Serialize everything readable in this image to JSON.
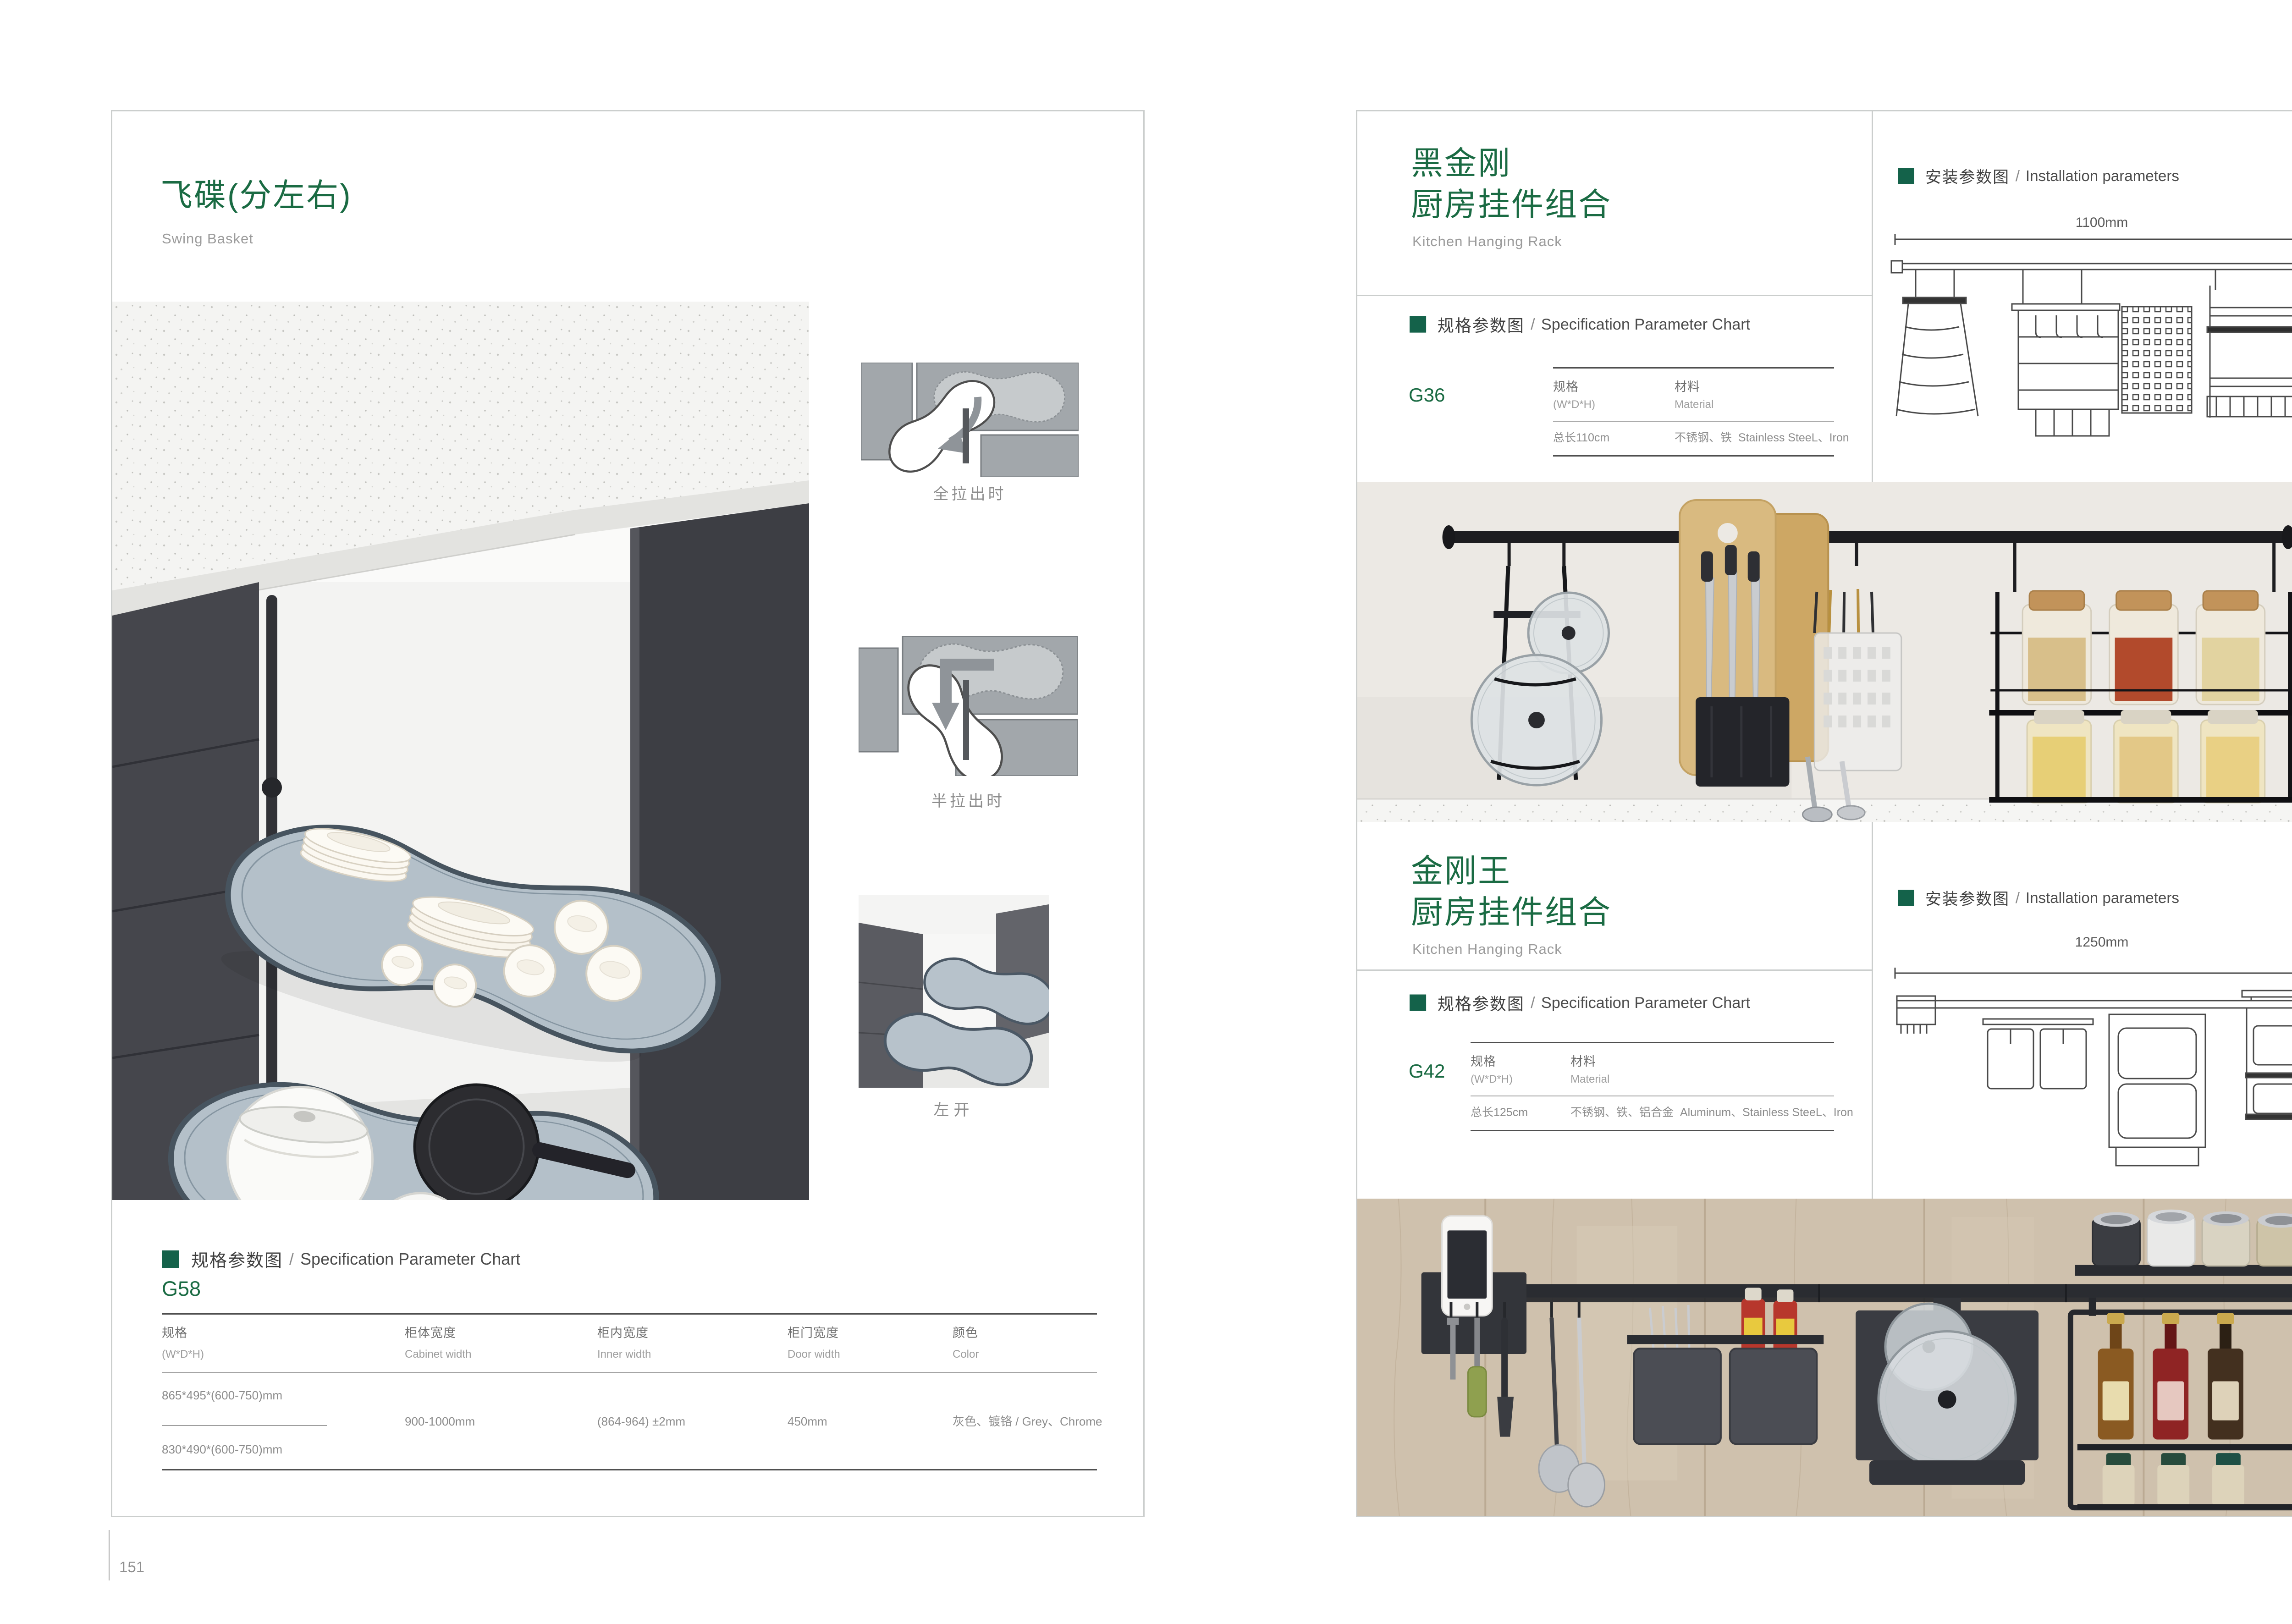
{
  "common": {
    "sep": "/"
  },
  "colors": {
    "accent_green": "#1a6b43",
    "marker_green": "#14624a",
    "border_gray": "#cbcecd"
  },
  "left": {
    "title": "飞碟(分左右)",
    "subtitle": "Swing Basket",
    "captions": {
      "full": "全拉出时",
      "half": "半拉出时",
      "open": "左开"
    },
    "section": {
      "cn": "规格参数图",
      "en": "Specification Parameter Chart"
    },
    "model": "G58",
    "table": {
      "h_spec_cn": "规格",
      "h_spec_en": "(W*D*H)",
      "h_cab_cn": "柜体宽度",
      "h_cab_en": "Cabinet width",
      "h_inner_cn": "柜内宽度",
      "h_inner_en": "Inner width",
      "h_door_cn": "柜门宽度",
      "h_door_en": "Door width",
      "h_color_cn": "颜色",
      "h_color_en": "Color",
      "size_a": "865*495*(600-750)mm",
      "size_b": "830*490*(600-750)mm",
      "cabinet_width": "900-1000mm",
      "inner_width": "(864-964) ±2mm",
      "door_width": "450mm",
      "color": "灰色、镀铬 / Grey、Chrome"
    },
    "page_number": "151"
  },
  "right": {
    "install_section": {
      "cn": "安装参数图",
      "en": "Installation parameters"
    },
    "spec_section": {
      "cn": "规格参数图",
      "en": "Specification Parameter Chart"
    },
    "table_headers": {
      "spec_cn": "规格",
      "spec_en": "(W*D*H)",
      "mat_cn": "材料",
      "mat_en": "Material"
    },
    "product1": {
      "title_line1": "黑金刚",
      "title_line2": "厨房挂件组合",
      "subtitle": "Kitchen Hanging Rack",
      "model": "G36",
      "spec_value": "总长110cm",
      "material": "不锈钢、铁  Stainless SteeL、Iron",
      "dim_width": "1100mm",
      "dim_height": "420mm"
    },
    "product2": {
      "title_line1": "金刚王",
      "title_line2": "厨房挂件组合",
      "subtitle": "Kitchen Hanging Rack",
      "model": "G42",
      "spec_value": "总长125cm",
      "material": "不锈钢、铁、铝合金  Aluminum、Stainless SteeL、Iron",
      "dim_width": "1250mm",
      "dim_height": "430mm"
    },
    "page_number": "152"
  }
}
